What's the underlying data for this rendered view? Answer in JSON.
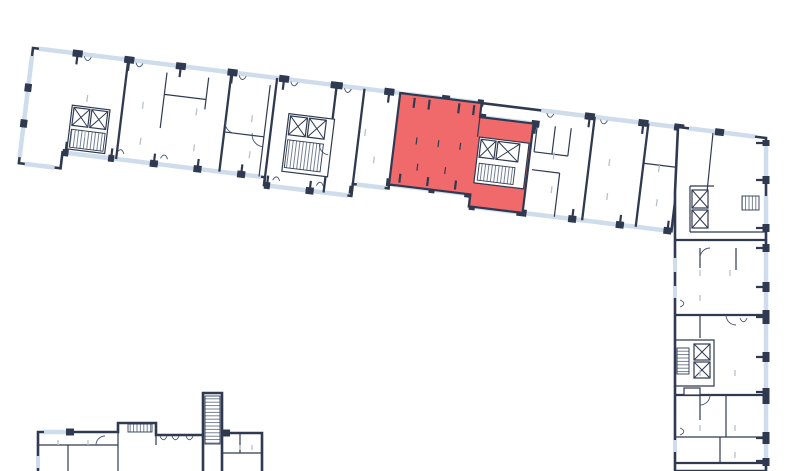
{
  "colors": {
    "background": "#ffffff",
    "wall": "#2f3a50",
    "wall_thin": "#44526a",
    "window": "#cfdcec",
    "tick_faint": "#b7c1cd",
    "hatch": "#66758c",
    "highlight": "#f0696b"
  },
  "plan": {
    "kind": "building-floor-plan",
    "highlighted_unit": {
      "fill": "#f0696b",
      "state": "highlighted"
    },
    "wings": {
      "top_wing": "long slanted wing with apartments, two elevator-stair cores",
      "right_wing": "vertical wing with stacked apartments and two cores",
      "bottom_fragment": "partial plan of neighbouring section cut by viewport"
    },
    "icons": {
      "elevator": "box-with-x",
      "stairs": "hatched-flight",
      "window": "light-blue-band",
      "door": "squiggle-opening"
    }
  }
}
